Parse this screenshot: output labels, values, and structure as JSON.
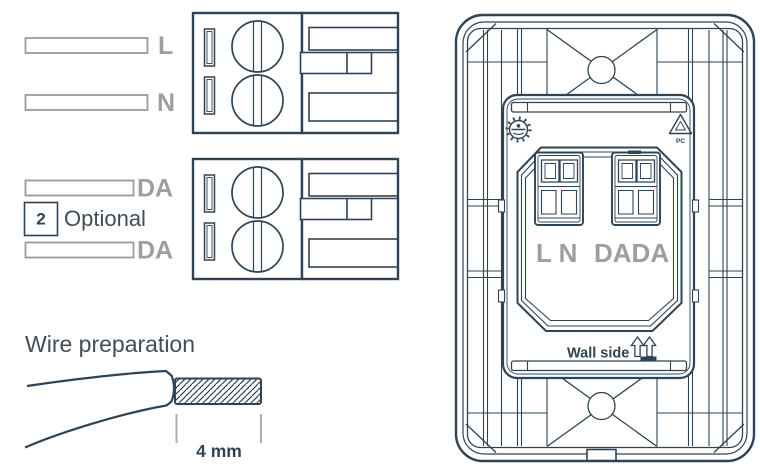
{
  "colors": {
    "line": "#2e4355",
    "wire_gray": "#9b9b9b",
    "label_gray": "#9e9e9e",
    "text_dark": "#3f4e58",
    "background": "#ffffff"
  },
  "left_panel": {
    "power_wiring": {
      "wire_labels": [
        "L",
        "N"
      ]
    },
    "dali_wiring": {
      "wire_labels": [
        "DA",
        "DA"
      ],
      "callout_number": "2",
      "callout_text": "Optional"
    },
    "wire_preparation": {
      "title": "Wire preparation",
      "strip_length": "4 mm"
    }
  },
  "device_rear": {
    "terminal_label_power": "L N",
    "terminal_label_dali": "DADA",
    "wall_side_label": "Wall side",
    "recycle_material_code": "PC",
    "icons": {
      "approval_mark": "dial-certification-mark-icon",
      "recycling_mark": "recycle-icon",
      "orientation_arrows": "up-arrows-icon",
      "screws": "screw-icon"
    }
  }
}
